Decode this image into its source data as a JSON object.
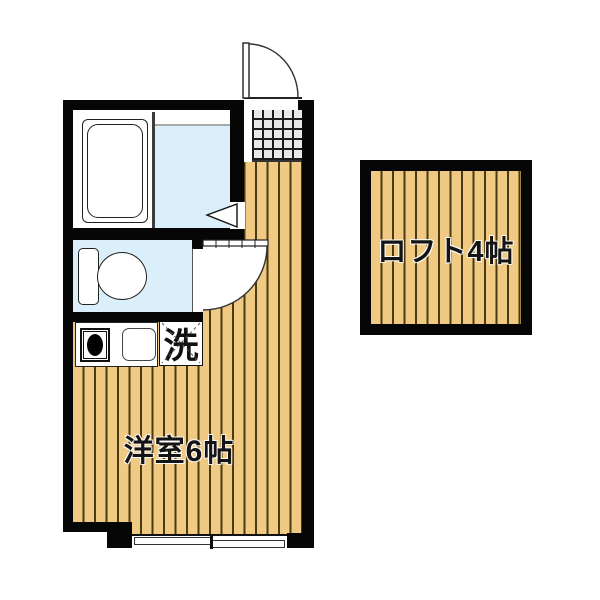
{
  "diagram_type": "japanese-apartment-floor-plan",
  "rooms": {
    "main": {
      "label": "洋室6帖",
      "meaning": "Western-style room, 6 tatami mats"
    },
    "loft": {
      "label": "ロフト4帖",
      "meaning": "Loft, 4 tatami mats"
    }
  },
  "fixtures": {
    "washer": {
      "label": "洗",
      "meaning": "washing machine space",
      "symbol": "dashed X box"
    },
    "bathtub": {
      "icon": "bathtub-icon"
    },
    "shower_room_floor": {
      "icon": "wet-area-floor"
    },
    "toilet": {
      "icon": "toilet-icon"
    },
    "stove": {
      "icon": "stove-burner-icon"
    },
    "sink": {
      "icon": "kitchen-sink-icon"
    },
    "entrance_tile": {
      "icon": "entrance-tile-grid"
    },
    "entrance_door": {
      "icon": "swing-door-arc"
    },
    "toilet_door": {
      "icon": "swing-door-arc"
    },
    "bath_door": {
      "icon": "folding-door-triangle"
    },
    "window": {
      "icon": "sliding-window"
    }
  },
  "colors": {
    "wall": "#060606",
    "wood_floor": "#F0CA83",
    "wood_stripe": "#4A3A12",
    "water_blue": "#DAEFFA",
    "tile_gray": "#E8E8E8",
    "line": "#222222",
    "background": "#FFFFFF"
  }
}
